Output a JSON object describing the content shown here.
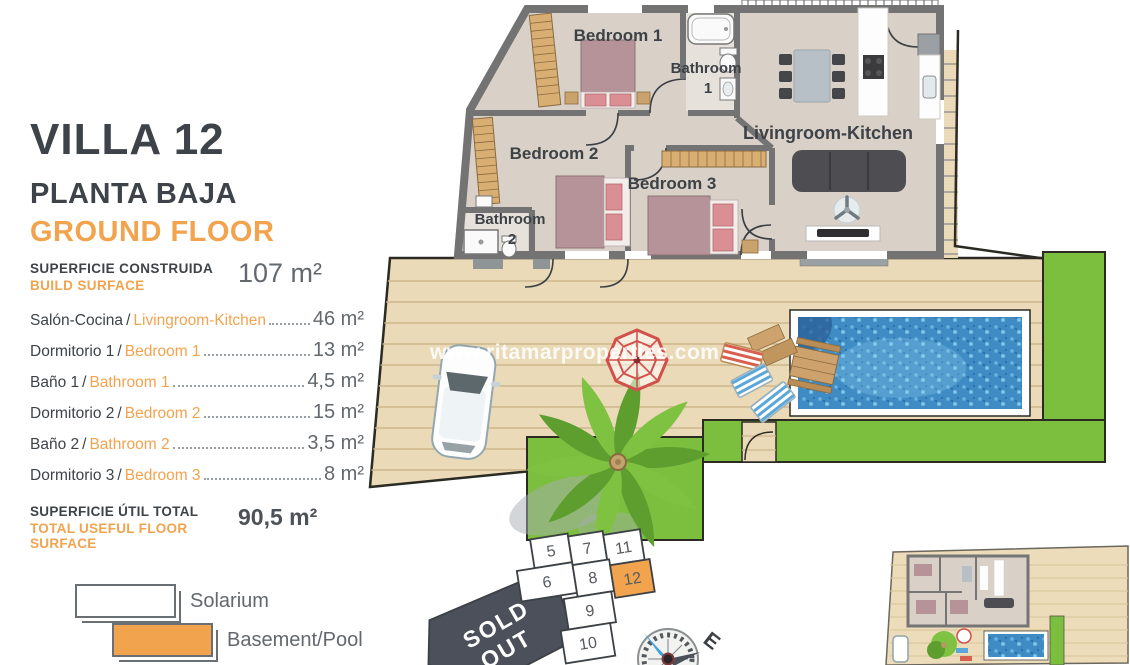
{
  "panel": {
    "title": "VILLA 12",
    "subtitle_es": "PLANTA BAJA",
    "subtitle_en": "GROUND FLOOR",
    "separator": "/",
    "build_surface": {
      "label_es": "SUPERFICIE CONSTRUIDA",
      "label_en": "BUILD SURFACE",
      "value": "107 m²"
    },
    "rooms": [
      {
        "name_es": "Salón-Cocina",
        "name_en": "Livingroom-Kitchen",
        "value": "46 m²"
      },
      {
        "name_es": "Dormitorio 1",
        "name_en": "Bedroom 1",
        "value": "13 m²"
      },
      {
        "name_es": "Baño 1",
        "name_en": "Bathroom 1",
        "value": "4,5 m²"
      },
      {
        "name_es": "Dormitorio 2",
        "name_en": "Bedroom 2",
        "value": "15 m²"
      },
      {
        "name_es": "Baño 2",
        "name_en": "Bathroom 2",
        "value": "3,5 m²"
      },
      {
        "name_es": "Dormitorio 3",
        "name_en": "Bedroom 3",
        "value": "8 m²"
      }
    ],
    "total": {
      "label_es": "SUPERFICIE ÚTIL TOTAL",
      "label_en": "TOTAL USEFUL FLOOR SURFACE",
      "value": "90,5 m²"
    }
  },
  "legend": {
    "items": [
      {
        "label": "Solarium",
        "color": "#ffffff"
      },
      {
        "label": "Basement/Pool",
        "color": "#f2a34e"
      }
    ]
  },
  "watermark": "www.ritamarproperties.com",
  "plan_labels": {
    "bedroom1": "Bedroom 1",
    "bathroom1_line1": "Bathroom",
    "bathroom1_line2": "1",
    "bedroom2": "Bedroom 2",
    "bedroom3": "Bedroom 3",
    "bathroom2_line1": "Bathroom",
    "bathroom2_line2": "2",
    "livingroom": "Livingroom-Kitchen"
  },
  "plot_map": {
    "cells": [
      {
        "label": "5"
      },
      {
        "label": "7"
      },
      {
        "label": "11"
      },
      {
        "label": "6"
      },
      {
        "label": "8"
      },
      {
        "label": "12",
        "highlighted": true
      },
      {
        "label": "9"
      },
      {
        "label": "10"
      }
    ],
    "sold_out_line1": "SOLD",
    "sold_out_line2": "OUT",
    "compass_label": "E"
  },
  "colors": {
    "accent_orange": "#f2a34e",
    "text_dark": "#3d4349",
    "value_gray": "#62686d",
    "grass_green": "#7cbf3f",
    "pool_blue": "#3f8cc4",
    "deck_beige": "#ebdab8",
    "wall_gray": "#737373",
    "sold_out_gray": "#4b505a"
  }
}
